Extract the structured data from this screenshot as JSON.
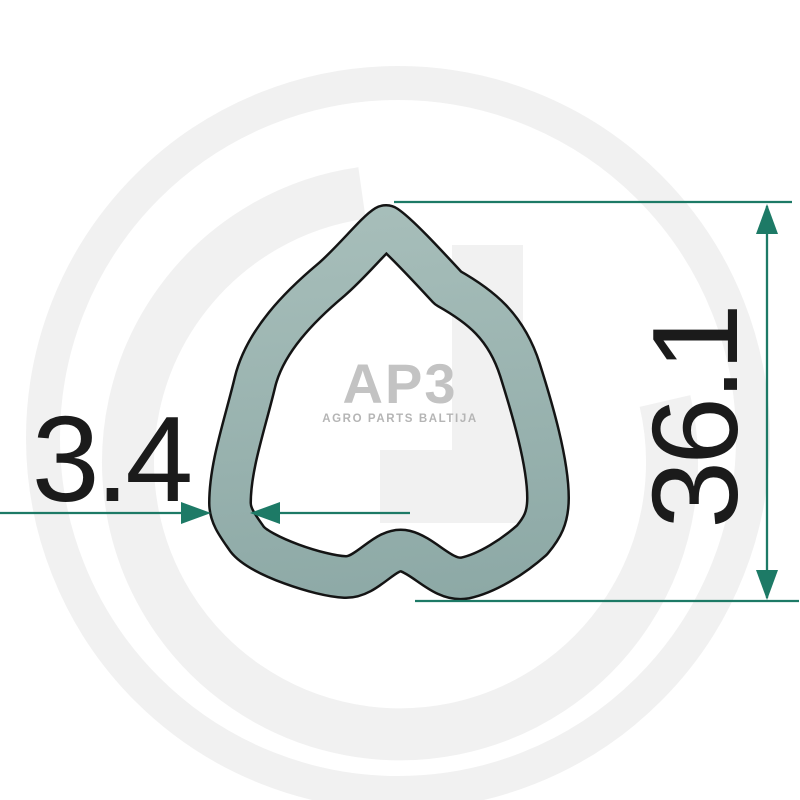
{
  "labels": {
    "wall_thickness": "3.4",
    "outer_dimension": "36.1"
  },
  "watermark": {
    "logo": "AP3",
    "subtitle": "AGRO PARTS BALTIJA"
  },
  "colors": {
    "dimension_teal": "#1d7a66",
    "outline_black": "#141414",
    "tube_fill_light": "#a7beba",
    "tube_fill_dark": "#8da9a6",
    "watermark_gray": "#f1f1f1",
    "logo_gray": "#c3c3c3",
    "text_black": "#1b1b1b"
  }
}
